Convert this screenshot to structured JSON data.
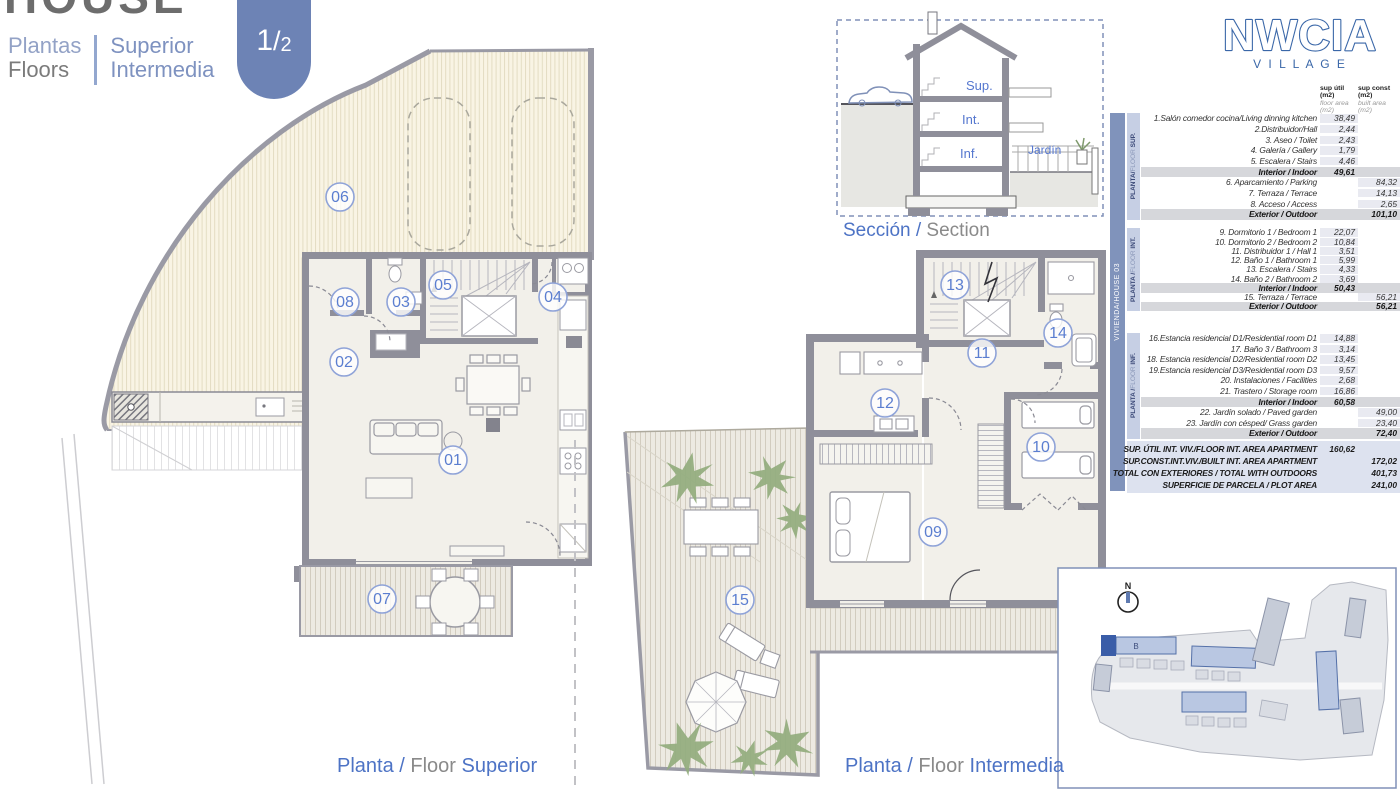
{
  "header": {
    "title": "HOUSE",
    "left_line1": "Plantas",
    "left_line2": "Floors",
    "right_line1": "Superior",
    "right_line2": "Intermedia",
    "page_num": "1",
    "page_sep": "/",
    "page_den": "2"
  },
  "logo": {
    "name": "NWCIA",
    "subtitle": "V I L L A G E"
  },
  "section_drawing": {
    "cap_es": "Sección /",
    "cap_en": " Section",
    "labels": {
      "sup": "Sup.",
      "int": "Int.",
      "inf": "Inf.",
      "jardin": "Jardín"
    }
  },
  "plans": {
    "superior": {
      "cap_es": "Planta /",
      "cap_mid": " Floor ",
      "cap_name": " Superior",
      "rooms": [
        "06",
        "08",
        "03",
        "05",
        "04",
        "02",
        "01",
        "07"
      ]
    },
    "intermedia": {
      "cap_es": "Planta /",
      "cap_mid": " Floor ",
      "cap_name": " Intermedia",
      "rooms": [
        "13",
        "14",
        "11",
        "12",
        "10",
        "09",
        "15"
      ]
    }
  },
  "site_plan": {
    "north_label": "N",
    "building_label": "B"
  },
  "colors": {
    "accent_blue": "#6d83b5",
    "logo_blue": "#3a67a8",
    "circle_blue": "#5b7ed0",
    "plant_green": "#93ad7e",
    "wall_gray": "#8f8f9a"
  },
  "table": {
    "house_label": "VIVIENDA/HOUSE 03",
    "col1": {
      "t1": "sup útil",
      "t2": "(m2)",
      "s1": "floor area",
      "s2": "(m2)"
    },
    "col2": {
      "t1": "sup const",
      "t2": "(m2)",
      "s1": "built area",
      "s2": "(m2)"
    },
    "sections": [
      {
        "bar": {
          "b1": "PLANTA/",
          "light": "FLOOR ",
          "b2": "SUP."
        },
        "rows": [
          {
            "label": "1.Salón comedor cocina/Living dinning kitchen",
            "util": "38,49",
            "built": "",
            "type": "int"
          },
          {
            "label": "2.Distribuidor/Hall",
            "util": "2,44",
            "built": "",
            "type": "int"
          },
          {
            "label": "3. Aseo / Toilet",
            "util": "2,43",
            "built": "",
            "type": "int"
          },
          {
            "label": "4. Galería / Gallery",
            "util": "1,79",
            "built": "",
            "type": "int"
          },
          {
            "label": "5. Escalera / Stairs",
            "util": "4,46",
            "built": "",
            "type": "int"
          },
          {
            "label": "Interior / Indoor",
            "util": "49,61",
            "built": "",
            "type": "sub"
          },
          {
            "label": "6. Aparcamiento / Parking",
            "util": "",
            "built": "84,32",
            "type": "ext"
          },
          {
            "label": "7. Terraza / Terrace",
            "util": "",
            "built": "14,13",
            "type": "ext"
          },
          {
            "label": "8. Acceso / Access",
            "util": "",
            "built": "2,65",
            "type": "ext"
          },
          {
            "label": "Exterior / Outdoor",
            "util": "",
            "built": "101,10",
            "type": "sub"
          }
        ]
      },
      {
        "bar": {
          "b1": "PLANTA /",
          "light": "FLOOR ",
          "b2": "INT."
        },
        "rows": [
          {
            "label": "9.  Dormitorio 1 / Bedroom 1",
            "util": "22,07",
            "built": "",
            "type": "int"
          },
          {
            "label": "10.  Dormitorio 2 / Bedroom 2",
            "util": "10,84",
            "built": "",
            "type": "int"
          },
          {
            "label": "11.  Distribuidor 1 / Hall 1",
            "util": "3,51",
            "built": "",
            "type": "int"
          },
          {
            "label": "12.  Baño 1 / Bathroom 1",
            "util": "5,99",
            "built": "",
            "type": "int"
          },
          {
            "label": "13. Escalera / Stairs",
            "util": "4,33",
            "built": "",
            "type": "int"
          },
          {
            "label": "14. Baño 2 / Bathroom 2",
            "util": "3,69",
            "built": "",
            "type": "int"
          },
          {
            "label": "Interior / Indoor",
            "util": "50,43",
            "built": "",
            "type": "sub"
          },
          {
            "label": "15. Terraza / Terrace",
            "util": "",
            "built": "56,21",
            "type": "ext"
          },
          {
            "label": "Exterior / Outdoor",
            "util": "",
            "built": "56,21",
            "type": "sub"
          }
        ]
      },
      {
        "bar": {
          "b1": "PLANTA /",
          "light": "FLOOR ",
          "b2": "INF."
        },
        "rows": [
          {
            "label": "16.Estancia residencial D1/Residential  room D1",
            "util": "14,88",
            "built": "",
            "type": "int"
          },
          {
            "label": "17. Baño 3 / Bathroom 3",
            "util": "3,14",
            "built": "",
            "type": "int"
          },
          {
            "label": "18. Estancia residencial D2/Residential room D2",
            "util": "13,45",
            "built": "",
            "type": "int"
          },
          {
            "label": "19.Estancia residencial D3/Residential  room D3",
            "util": "9,57",
            "built": "",
            "type": "int"
          },
          {
            "label": "20. Instalaciones / Facilities",
            "util": "2,68",
            "built": "",
            "type": "int"
          },
          {
            "label": "21. Trastero  / Storage room",
            "util": "16,86",
            "built": "",
            "type": "int"
          },
          {
            "label": "Interior / Indoor",
            "util": "60,58",
            "built": "",
            "type": "sub"
          },
          {
            "label": "22. Jardín solado / Paved garden",
            "util": "",
            "built": "49,00",
            "type": "ext"
          },
          {
            "label": "23. Jardín con césped/ Grass garden",
            "util": "",
            "built": "23,40",
            "type": "ext"
          },
          {
            "label": "Exterior / Outdoor",
            "util": "",
            "built": "72,40",
            "type": "sub"
          }
        ]
      }
    ],
    "totals": [
      {
        "label": "SUP. ÚTIL INT. VIV./FLOOR INT. AREA APARTMENT",
        "util": "160,62",
        "built": ""
      },
      {
        "label": "SUP.CONST.INT.VIV./BUILT INT. AREA APARTMENT",
        "util": "",
        "built": "172,02"
      },
      {
        "label": "TOTAL CON EXTERIORES / TOTAL WITH OUTDOORS",
        "util": "",
        "built": "401,73"
      },
      {
        "label": "SUPERFICIE DE PARCELA / PLOT AREA",
        "util": "",
        "built": "241,00"
      }
    ]
  }
}
